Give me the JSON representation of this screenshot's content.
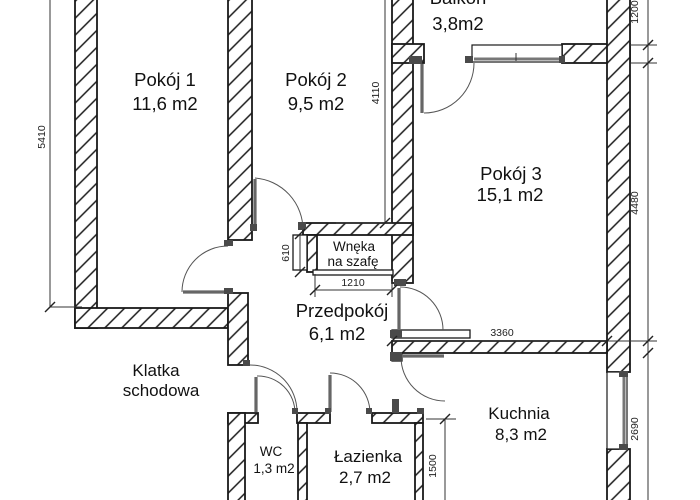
{
  "plan_title": "Apartment floor plan",
  "rooms": {
    "balkon": {
      "name": "Balkon",
      "area": "3,8m2"
    },
    "pokoj1": {
      "name": "Pokój 1",
      "area": "11,6 m2"
    },
    "pokoj2": {
      "name": "Pokój 2",
      "area": "9,5 m2"
    },
    "pokoj3": {
      "name": "Pokój 3",
      "area": "15,1 m2"
    },
    "wneka": {
      "line1": "Wnęka",
      "line2": "na szafę"
    },
    "przedpokoj": {
      "name": "Przedpokój",
      "area": "6,1 m2"
    },
    "klatka": {
      "line1": "Klatka",
      "line2": "schodowa"
    },
    "wc": {
      "name": "WC",
      "area": "1,3 m2"
    },
    "lazienka": {
      "name": "Łazienka",
      "area": "2,7 m2"
    },
    "kuchnia": {
      "name": "Kuchnia",
      "area": "8,3 m2"
    }
  },
  "dimensions_mm": {
    "pokoj1_height": "5410",
    "pokoj2_height": "4110",
    "balkon_depth": "1200",
    "pokoj3_height": "4480",
    "kuchnia_height": "2690",
    "kuchnia_width": "3360",
    "wneka_depth": "610",
    "wneka_width": "1210",
    "lazienka_height": "1500"
  },
  "colors": {
    "line": "#1a1a1a",
    "door_leaf": "#666666",
    "background": "#ffffff"
  }
}
